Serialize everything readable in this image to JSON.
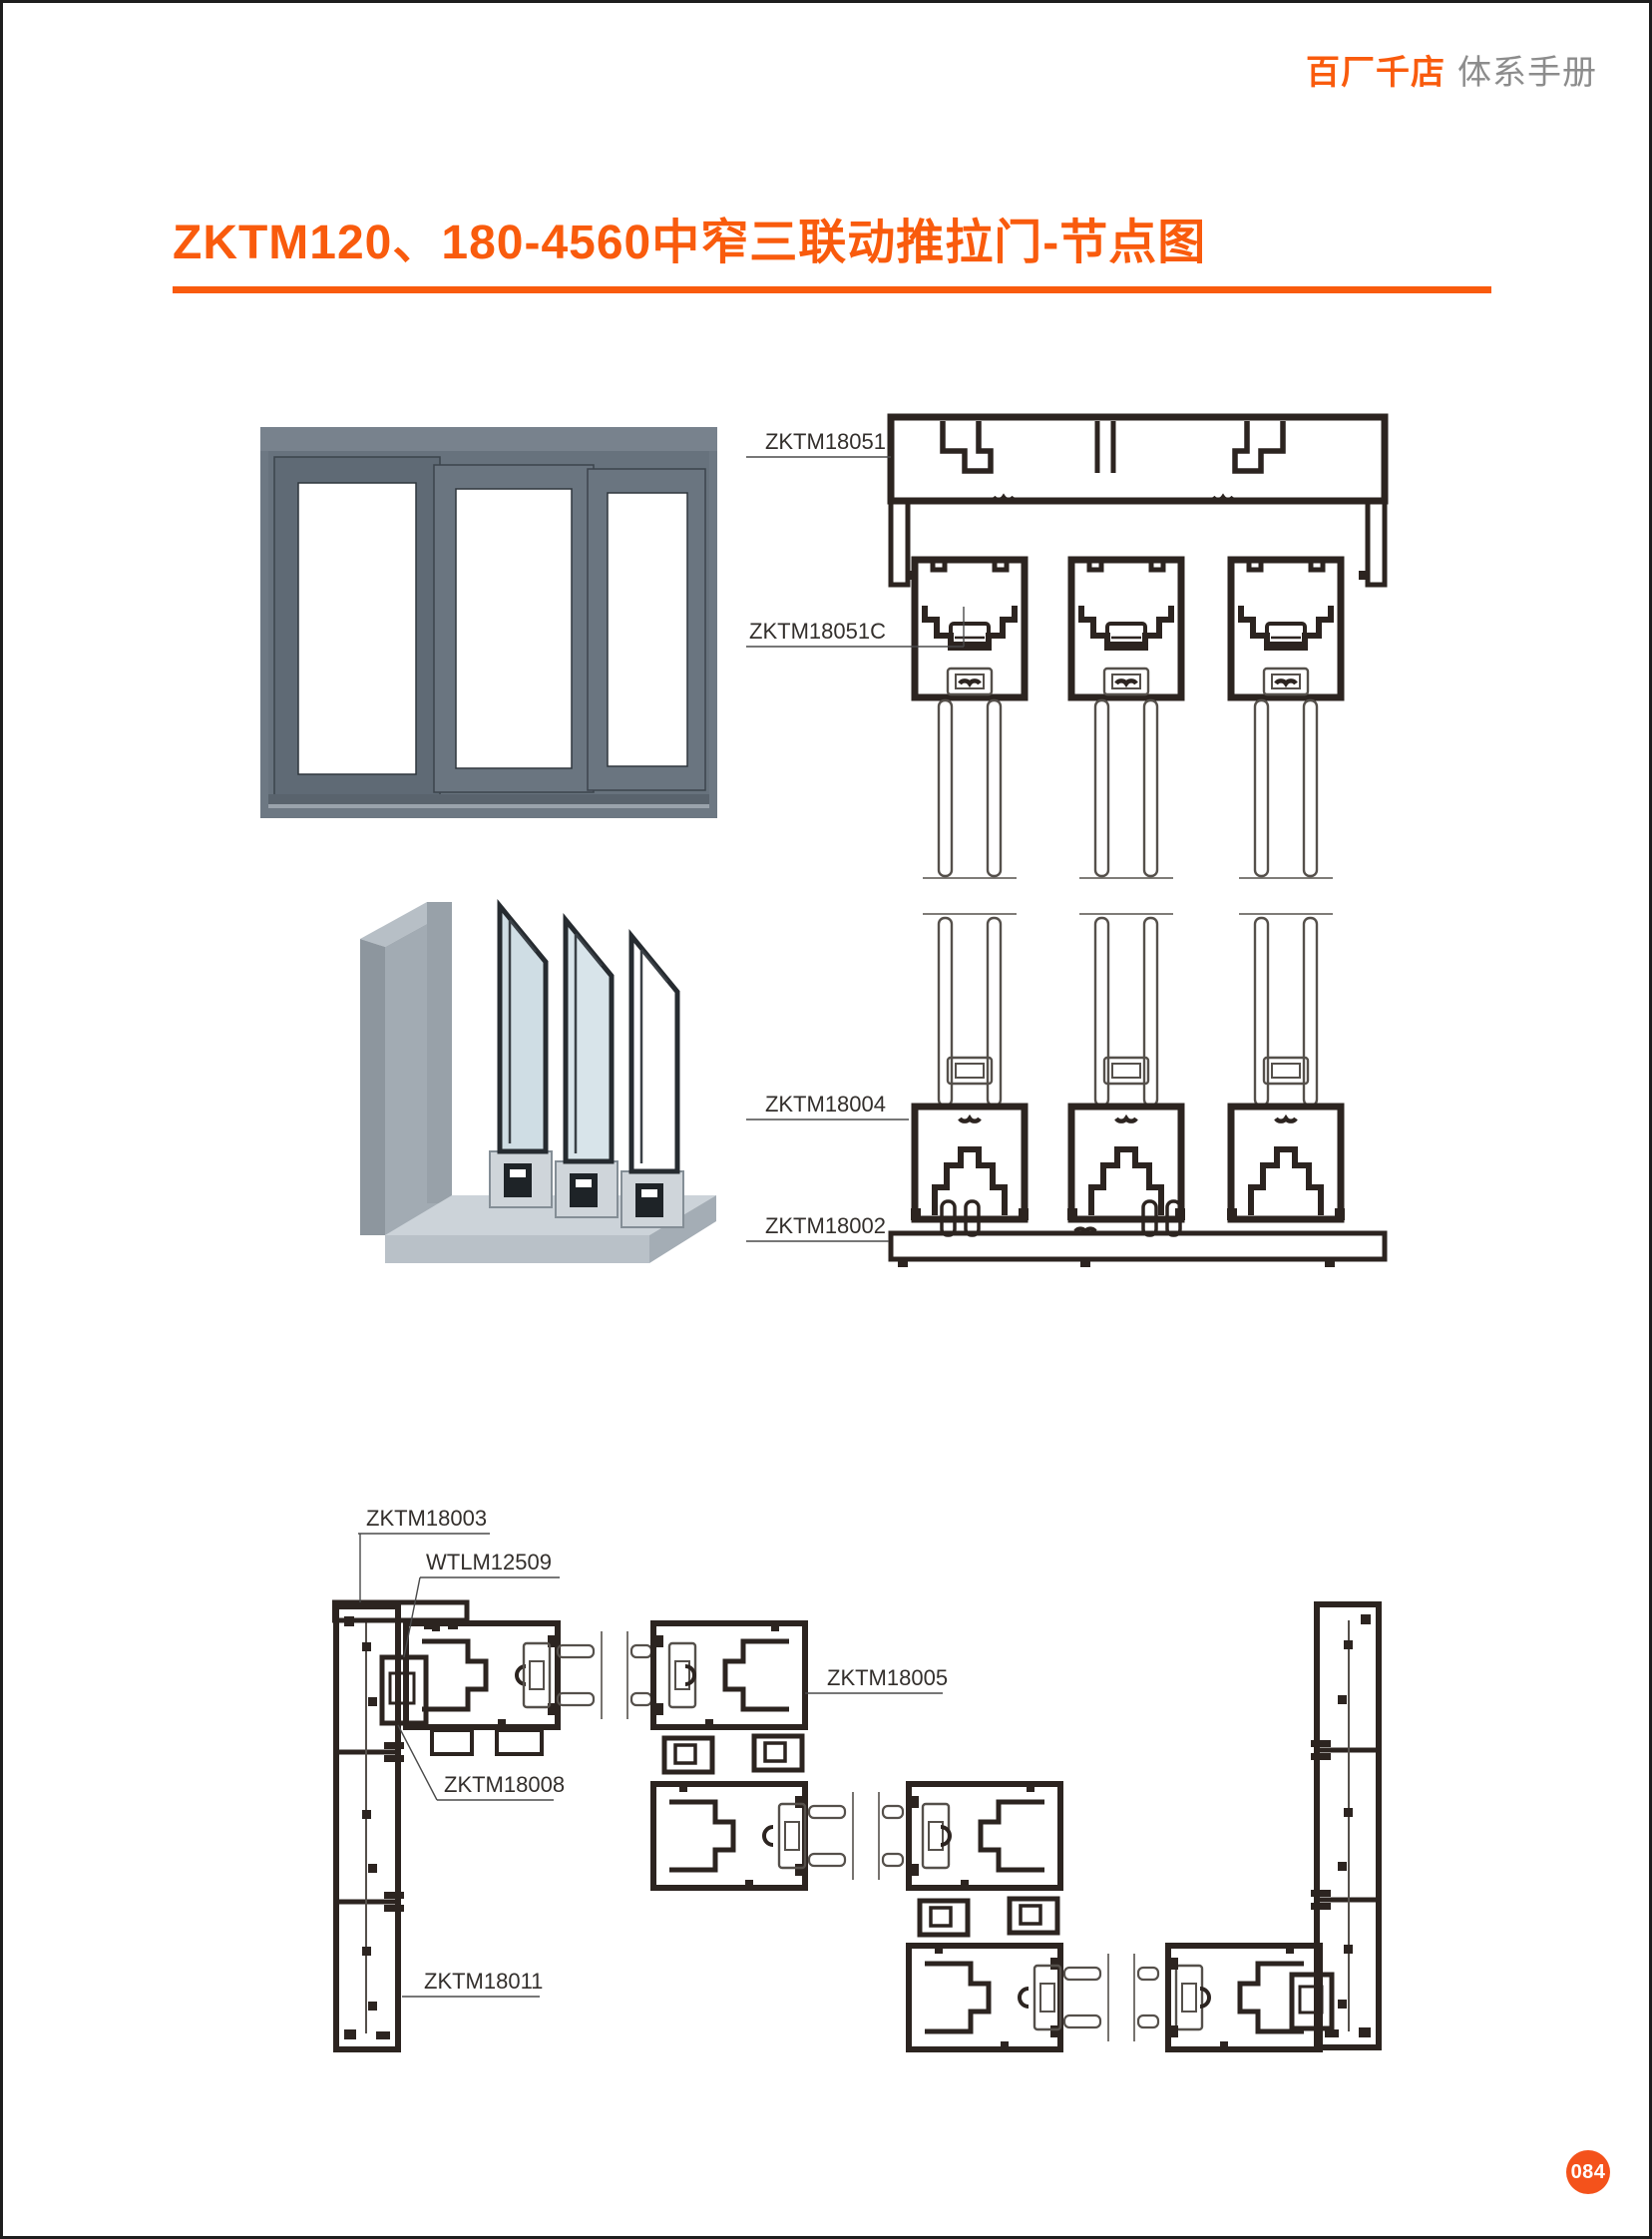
{
  "header": {
    "brand": "百厂千店",
    "subtitle": "体系手册"
  },
  "title": "ZKTM120、180-4560中窄三联动推拉门-节点图",
  "page_badge": "084",
  "colors": {
    "accent": "#F95B0D",
    "badge": "#F4521B",
    "drawing_line": "#2C2420",
    "label_text": "#332F2C",
    "door_frame_gray": "#6B7682"
  },
  "vertical_section": {
    "labels": {
      "head_frame": "ZKTM18051",
      "sash_top_rail": "ZKTM18051C",
      "sash_bottom_rail": "ZKTM18004",
      "sill_track": "ZKTM18002"
    }
  },
  "plan_section": {
    "labels": {
      "jamb_top": "ZKTM18003",
      "connector": "WTLM12509",
      "filler": "ZKTM18008",
      "interlock_stile": "ZKTM18005",
      "jamb_lower": "ZKTM18011"
    }
  }
}
